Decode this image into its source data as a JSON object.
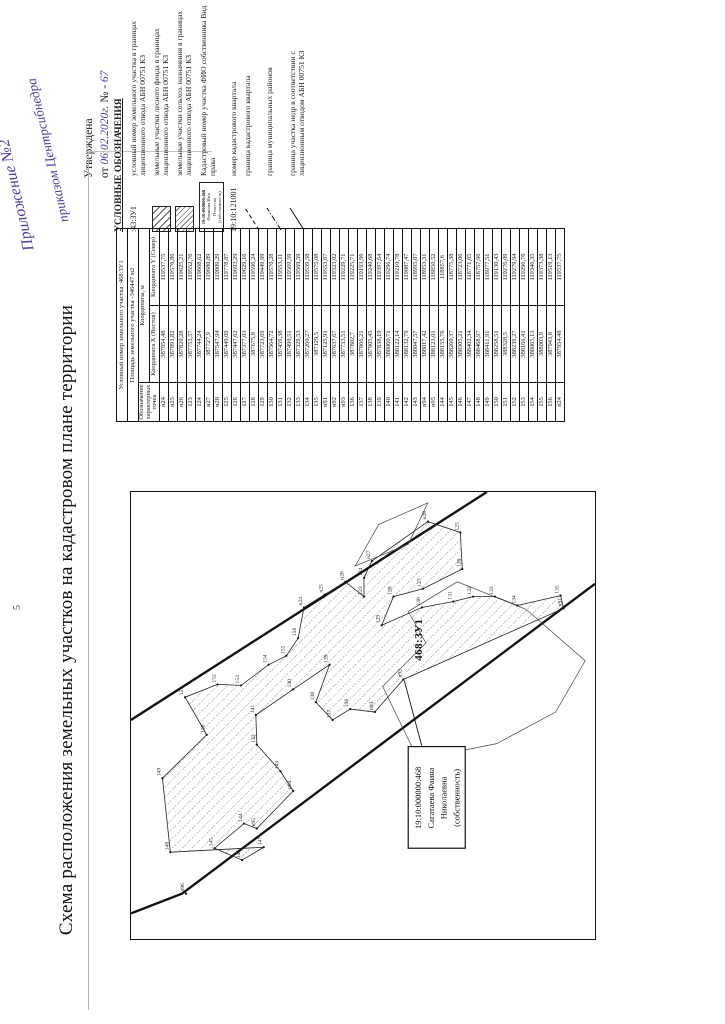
{
  "page": {
    "page_marker": "5"
  },
  "annotations": {
    "handwritten_line1": "Приложение №2",
    "handwritten_line2": "приказом Центрсибнедра",
    "approved_label": "Утверждена",
    "approved_prefix": "от",
    "approved_date": "06.02.2020г.",
    "approved_no_sign": "№ -",
    "approved_number": "67"
  },
  "title": "Схема расположения земельных участков на кадастровом плане территории",
  "legend": {
    "header": "УСЛОВНЫЕ ОБОЗНАЧЕНИЯ",
    "items": [
      {
        "symbol": "text",
        "symbol_text": ":43:ЗУ1",
        "label": "условный номер земельного участка в границах лицензионного отвода АБН 00751 КЗ"
      },
      {
        "symbol": "hatch-forest",
        "label": "земельные участки лесного фонда в границах лицензионного отвода АБН 00751 КЗ"
      },
      {
        "symbol": "hatch-agri",
        "label": "земельные участки сельхоз. назначения в границах лицензионного отвода АБН 00751 КЗ"
      },
      {
        "symbol": "owner-box",
        "symbol_lines": [
          "19:10:000000:468",
          "Фамилия Имя",
          "Отчество",
          "(собственность)"
        ],
        "label": "Кадастровый номер участка ФИО собственника Вид права"
      },
      {
        "symbol": "text",
        "symbol_text": "19:10:121001",
        "label": "номер кадастрового квартала"
      },
      {
        "symbol": "line-dashed",
        "label": "граница кадастрового квартала"
      },
      {
        "symbol": "line-dashdot",
        "label": "граница муниципальных районов"
      },
      {
        "symbol": "line-solid",
        "label": "граница участка недр в соответствии с лицензионным отводом АБН 00751 КЗ"
      }
    ]
  },
  "table": {
    "title_row": "Условный номер земельного участка :468:ЗУ1",
    "area_row": "Площадь земельного участка -346447 м2",
    "col_point": "Обозначение характерных точек",
    "coords_header": "Координаты, м",
    "col_x": "Координата X (Восток)",
    "col_y": "Координата Y (Север)",
    "rows": [
      [
        "н24",
        "387954,48",
        "119537,75"
      ],
      [
        "н25",
        "387891,82",
        "119576,86"
      ],
      [
        "н26",
        "387820,28",
        "119625,21"
      ],
      [
        "123",
        "387753,57",
        "119552,76"
      ],
      [
        "124",
        "387744,24",
        "119668,62"
      ],
      [
        "н27",
        "387727,9",
        "119680,89"
      ],
      [
        "н28",
        "387547,94",
        "119809,29"
      ],
      [
        "125",
        "387449,09",
        "119778,87"
      ],
      [
        "126",
        "387447,62",
        "119693,29"
      ],
      [
        "127",
        "387377,03",
        "119629,16"
      ],
      [
        "128",
        "387675,8",
        "119596,24"
      ],
      [
        "129",
        "387723,69",
        "119449,99"
      ],
      [
        "130",
        "387564,72",
        "119570,28"
      ],
      [
        "131",
        "387459,38",
        "119553,11"
      ],
      [
        "132",
        "387490,51",
        "119569,59"
      ],
      [
        "133",
        "387329,53",
        "119569,59"
      ],
      [
        "134",
        "387260,27",
        "119539,58"
      ],
      [
        "135",
        "387129,5",
        "119575,08"
      ],
      [
        "н91",
        "387125,91",
        "119553,67"
      ],
      [
        "н92",
        "387637,67",
        "119323,02"
      ],
      [
        "н93",
        "387733,51",
        "119229,71"
      ],
      [
        "136",
        "387802,7",
        "119225,71"
      ],
      [
        "137",
        "387866,21",
        "119193,96"
      ],
      [
        "138",
        "387905,45",
        "119240,68"
      ],
      [
        "139",
        "387838,19",
        "119397,64"
      ],
      [
        "140",
        "388060,71",
        "119296,74"
      ],
      [
        "141",
        "388122,14",
        "119210,78"
      ],
      [
        "142",
        "388132,79",
        "119087,47"
      ],
      [
        "143",
        "388047,57",
        "118995,07"
      ],
      [
        "н94",
        "388017,42",
        "118953,31"
      ],
      [
        "н95",
        "388123,01",
        "118850,52"
      ],
      [
        "144",
        "388155,76",
        "118857,6"
      ],
      [
        "145",
        "388260,37",
        "118775,38"
      ],
      [
        "146",
        "388305,21",
        "118723,06"
      ],
      [
        "147",
        "388402,34",
        "118771,65"
      ],
      [
        "148",
        "388468,97",
        "118757,96"
      ],
      [
        "149",
        "388411,91",
        "118977,51"
      ],
      [
        "150",
        "388258,51",
        "119130,43"
      ],
      [
        "151",
        "388328,5",
        "119276,09"
      ],
      [
        "152",
        "388239,27",
        "119279,94"
      ],
      [
        "153",
        "388166,41",
        "119296,76"
      ],
      [
        "154",
        "388065,13",
        "119346,35"
      ],
      [
        "155",
        "388003,9",
        "119373,38"
      ],
      [
        "156",
        "387943,8",
        "119519,13"
      ],
      [
        "н24",
        "387954,48",
        "119537,75"
      ]
    ]
  },
  "map": {
    "parcel_label": "468:ЗУ1",
    "quarter_number": "19:10:121001",
    "owner_box_lines": [
      "19:10:000000:468",
      "Сагатаева Фаина",
      "Николаевна",
      "(собственность)"
    ],
    "points": [
      {
        "label": "н24",
        "x": 336,
        "y": 176
      },
      {
        "label": "н25",
        "x": 349,
        "y": 197
      },
      {
        "label": "н26",
        "x": 362,
        "y": 218
      },
      {
        "label": "123",
        "x": 347,
        "y": 237
      },
      {
        "label": "124",
        "x": 366,
        "y": 237
      },
      {
        "label": "н27",
        "x": 383,
        "y": 245
      },
      {
        "label": "н28",
        "x": 423,
        "y": 302
      },
      {
        "label": "125",
        "x": 412,
        "y": 335
      },
      {
        "label": "126",
        "x": 375,
        "y": 337
      },
      {
        "label": "127",
        "x": 355,
        "y": 297
      },
      {
        "label": "128",
        "x": 347,
        "y": 267
      },
      {
        "label": "129",
        "x": 318,
        "y": 255
      },
      {
        "label": "130",
        "x": 336,
        "y": 296
      },
      {
        "label": "131",
        "x": 342,
        "y": 328
      },
      {
        "label": "132",
        "x": 347,
        "y": 348
      },
      {
        "label": "133",
        "x": 347,
        "y": 370
      },
      {
        "label": "134",
        "x": 338,
        "y": 393
      },
      {
        "label": "135",
        "x": 348,
        "y": 437
      },
      {
        "label": "н91",
        "x": 335,
        "y": 440
      },
      {
        "label": "н92",
        "x": 263,
        "y": 277
      },
      {
        "label": "н93",
        "x": 230,
        "y": 248
      },
      {
        "label": "136",
        "x": 233,
        "y": 223
      },
      {
        "label": "137",
        "x": 222,
        "y": 205
      },
      {
        "label": "138",
        "x": 240,
        "y": 188
      },
      {
        "label": "139",
        "x": 278,
        "y": 202
      },
      {
        "label": "140",
        "x": 253,
        "y": 165
      },
      {
        "label": "141",
        "x": 227,
        "y": 127
      },
      {
        "label": "142",
        "x": 197,
        "y": 128
      },
      {
        "label": "143",
        "x": 170,
        "y": 152
      },
      {
        "label": "н94",
        "x": 150,
        "y": 165
      },
      {
        "label": "н95",
        "x": 112,
        "y": 128
      },
      {
        "label": "144",
        "x": 117,
        "y": 115
      },
      {
        "label": "145",
        "x": 92,
        "y": 85
      },
      {
        "label": "146",
        "x": 80,
        "y": 113
      },
      {
        "label": "147",
        "x": 93,
        "y": 135
      },
      {
        "label": "148",
        "x": 88,
        "y": 40
      },
      {
        "label": "149",
        "x": 163,
        "y": 32
      },
      {
        "label": "150",
        "x": 207,
        "y": 77
      },
      {
        "label": "151",
        "x": 245,
        "y": 55
      },
      {
        "label": "152",
        "x": 258,
        "y": 88
      },
      {
        "label": "153",
        "x": 257,
        "y": 112
      },
      {
        "label": "154",
        "x": 278,
        "y": 140
      },
      {
        "label": "155",
        "x": 287,
        "y": 158
      },
      {
        "label": "156",
        "x": 305,
        "y": 170
      },
      {
        "label": "н96",
        "x": 46,
        "y": 56,
        "standalone": true
      }
    ]
  }
}
